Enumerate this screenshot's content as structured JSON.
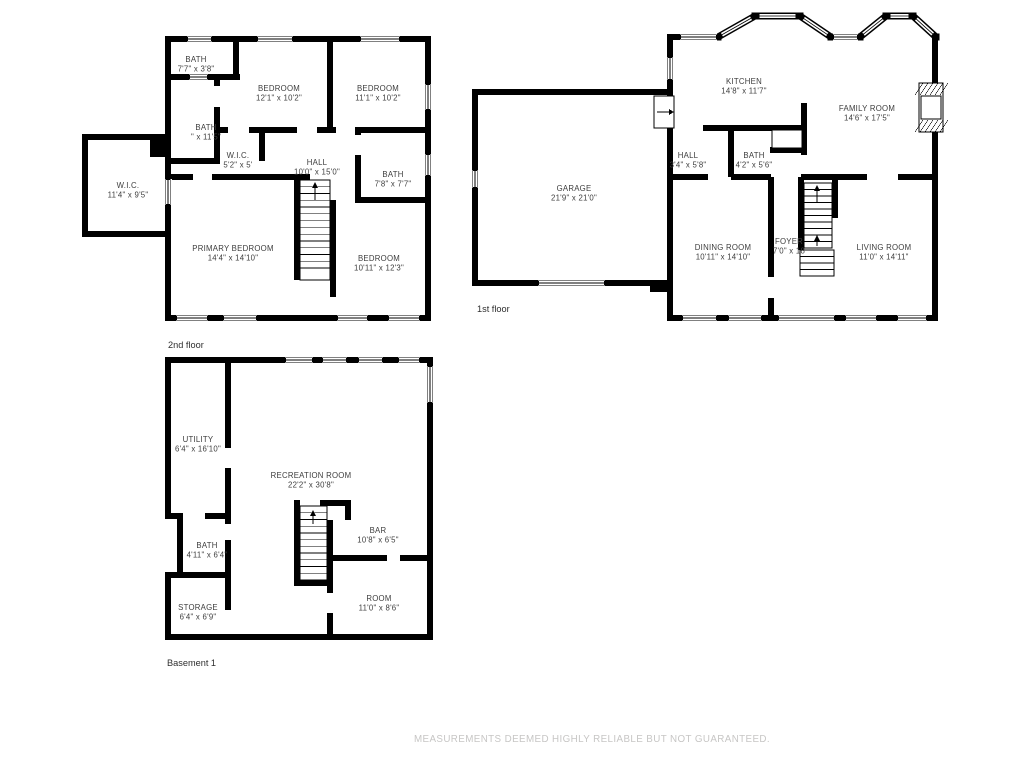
{
  "colors": {
    "wall": "#000000",
    "room_label": "#3d3d3d",
    "floor_label": "#2e2e2e",
    "disclaimer": "#c7c6c5",
    "background": "#ffffff"
  },
  "disclaimer": {
    "text": "MEASUREMENTS DEEMED HIGHLY RELIABLE BUT NOT GUARANTEED."
  },
  "floors": [
    {
      "name": "second-floor",
      "label": "2nd floor",
      "label_x": 168,
      "label_y": 348,
      "rooms": [
        {
          "room": "BATH",
          "dims": "7'7\" x 3'8\"",
          "x": 196,
          "y": 62
        },
        {
          "room": "BEDROOM",
          "dims": "12'1\" x 10'2\"",
          "x": 279,
          "y": 91
        },
        {
          "room": "BEDROOM",
          "dims": "11'1\" x 10'2\"",
          "x": 378,
          "y": 91
        },
        {
          "room": "BATH",
          "dims": "\" x 11'5\"",
          "x": 206,
          "y": 130
        },
        {
          "room": "W.I.C.",
          "dims": "5'2\" x 5'",
          "x": 238,
          "y": 158
        },
        {
          "room": "HALL",
          "dims": "10'0\" x 15'0\"",
          "x": 317,
          "y": 165
        },
        {
          "room": "BATH",
          "dims": "7'8\" x 7'7\"",
          "x": 393,
          "y": 177
        },
        {
          "room": "W.I.C.",
          "dims": "11'4\" x 9'5\"",
          "x": 128,
          "y": 188
        },
        {
          "room": "PRIMARY BEDROOM",
          "dims": "14'4\" x 14'10\"",
          "x": 233,
          "y": 251
        },
        {
          "room": "BEDROOM",
          "dims": "10'11\" x 12'3\"",
          "x": 379,
          "y": 261
        }
      ]
    },
    {
      "name": "first-floor",
      "label": "1st floor",
      "label_x": 477,
      "label_y": 312,
      "rooms": [
        {
          "room": "KITCHEN",
          "dims": "14'8\" x 11'7\"",
          "x": 744,
          "y": 84
        },
        {
          "room": "FAMILY ROOM",
          "dims": "14'6\" x 17'5\"",
          "x": 867,
          "y": 111
        },
        {
          "room": "GARAGE",
          "dims": "21'9\" x 21'0\"",
          "x": 574,
          "y": 191
        },
        {
          "room": "HALL",
          "dims": "3'4\" x 5'8\"",
          "x": 688,
          "y": 158
        },
        {
          "room": "BATH",
          "dims": "4'2\" x 5'6\"",
          "x": 754,
          "y": 158
        },
        {
          "room": "DINING ROOM",
          "dims": "10'11\" x 14'10\"",
          "x": 723,
          "y": 250
        },
        {
          "room": "FOYER",
          "dims": "7'0\" x 18",
          "x": 789,
          "y": 244
        },
        {
          "room": "LIVING ROOM",
          "dims": "11'0\" x 14'11\"",
          "x": 884,
          "y": 250
        }
      ]
    },
    {
      "name": "basement",
      "label": "Basement 1",
      "label_x": 167,
      "label_y": 666,
      "rooms": [
        {
          "room": "UTILITY",
          "dims": "6'4\" x 16'10\"",
          "x": 198,
          "y": 442
        },
        {
          "room": "RECREATION ROOM",
          "dims": "22'2\" x 30'8\"",
          "x": 311,
          "y": 478
        },
        {
          "room": "BATH",
          "dims": "4'11\" x 6'4\"",
          "x": 207,
          "y": 548
        },
        {
          "room": "STORAGE",
          "dims": "6'4\" x 6'9\"",
          "x": 198,
          "y": 610
        },
        {
          "room": "BAR",
          "dims": "10'8\" x 6'5\"",
          "x": 378,
          "y": 533
        },
        {
          "room": "ROOM",
          "dims": "11'0\" x 8'6\"",
          "x": 379,
          "y": 601
        }
      ]
    }
  ]
}
